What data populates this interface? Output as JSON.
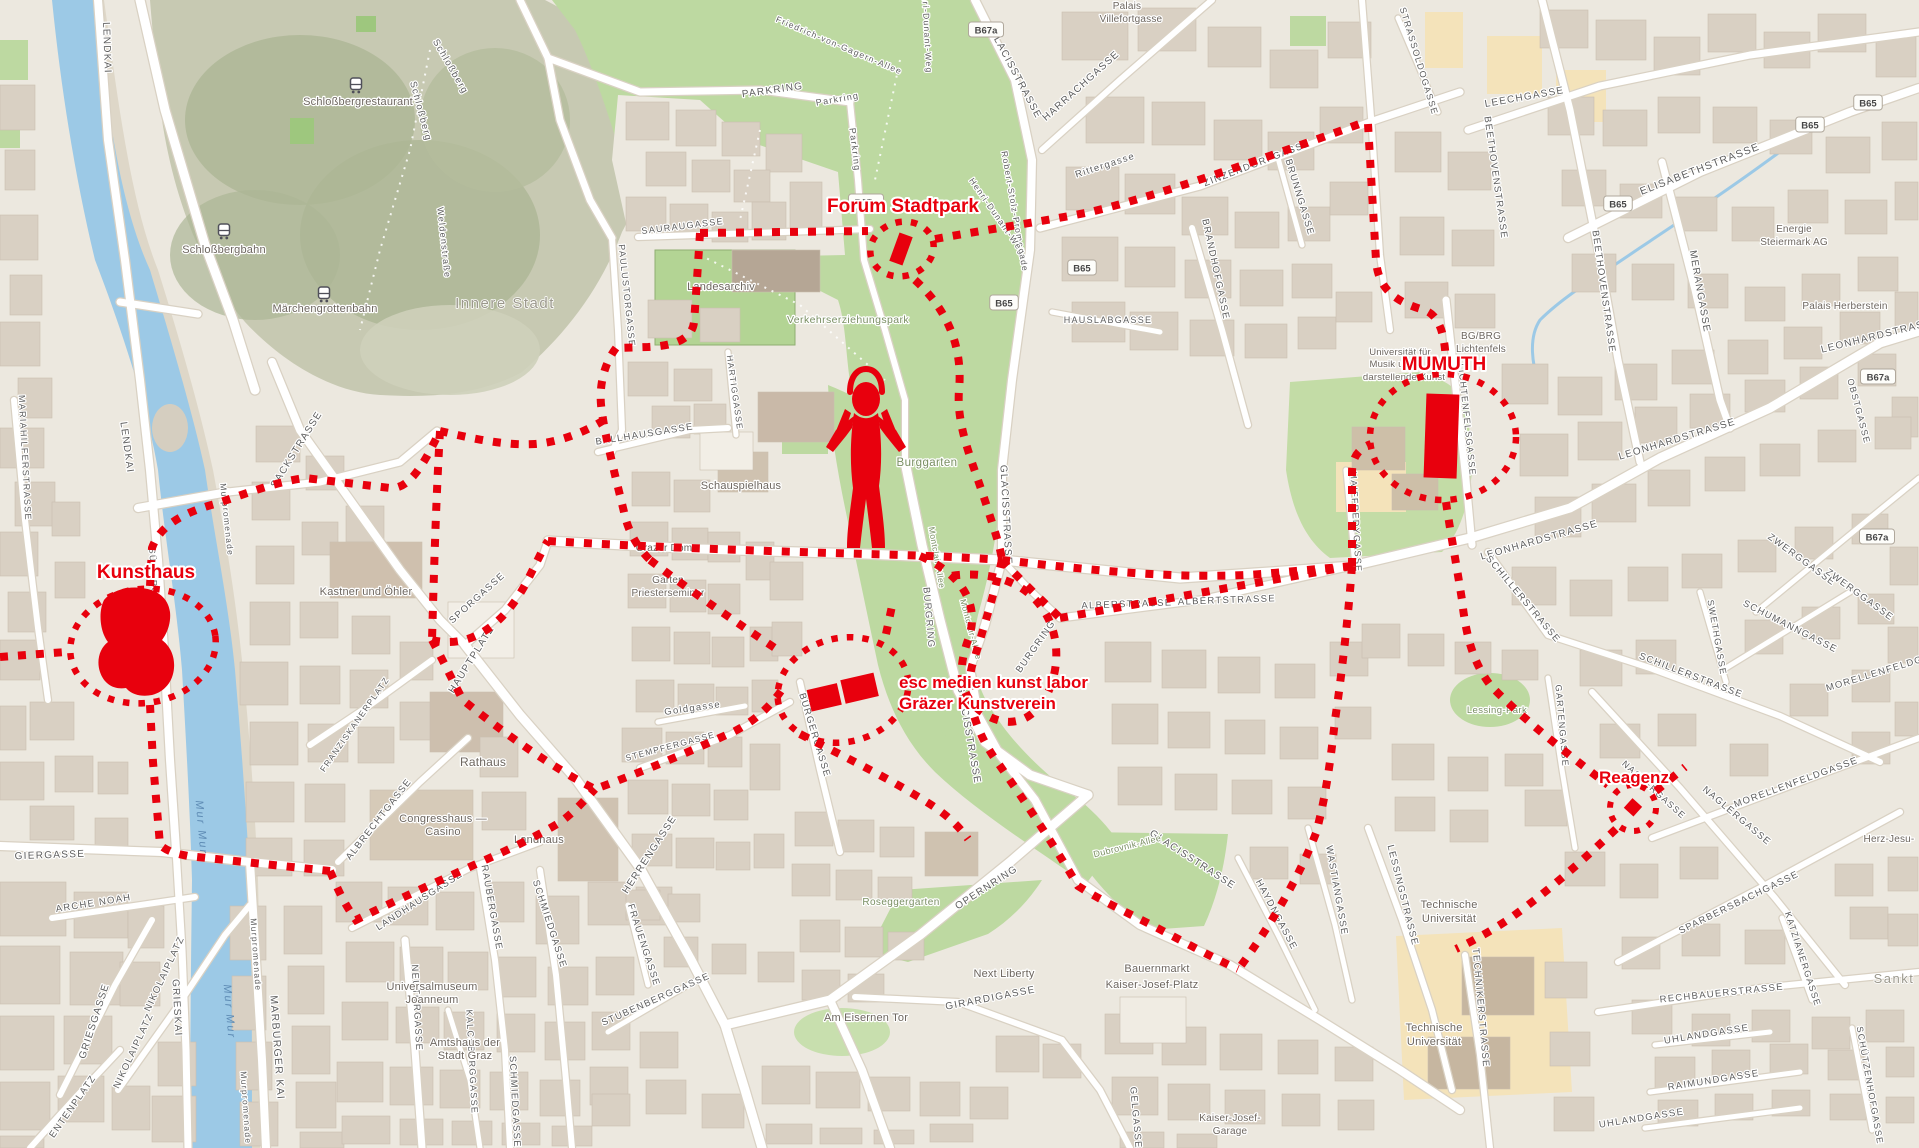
{
  "venues": {
    "kunsthaus": {
      "label": "Kunsthaus"
    },
    "forum_stadtpark": {
      "label": "Forum Stadtpark"
    },
    "mumuth": {
      "label": "MUMUTH"
    },
    "esc": {
      "label_line1": "esc medien kunst labor",
      "label_line2": "Gräzer Kunstverein"
    },
    "reagenz": {
      "label": "Reagenz"
    }
  },
  "map_labels": [
    {
      "t": "LENDKAI",
      "x": 104,
      "y": 48,
      "r": 88
    },
    {
      "t": "LENDKAI",
      "x": 124,
      "y": 448,
      "r": 82
    },
    {
      "t": "MARIAHILFERSTRASSE",
      "x": 22,
      "y": 458,
      "r": 87,
      "s": 9
    },
    {
      "t": "SÜDTIROLER PLATZ",
      "x": 152,
      "y": 600,
      "r": 87,
      "s": 8.5
    },
    {
      "t": "SACKSTRASSE",
      "x": 299,
      "y": 451,
      "r": -58
    },
    {
      "t": "HAUPTPLATZ",
      "x": 474,
      "y": 661,
      "r": -58
    },
    {
      "t": "SPORGASSE",
      "x": 479,
      "y": 600,
      "r": -42,
      "s": 9.5
    },
    {
      "t": "FRANZISKANERPLATZ",
      "x": 357,
      "y": 726,
      "r": -55,
      "s": 8.5
    },
    {
      "t": "ALBRECHTGASSE",
      "x": 381,
      "y": 821,
      "r": -52,
      "s": 9.5
    },
    {
      "t": "LANDHAUSGASSE",
      "x": 421,
      "y": 903,
      "r": -33,
      "s": 9.5
    },
    {
      "t": "RAUBERGASSE",
      "x": 489,
      "y": 908,
      "r": 80,
      "s": 9.5
    },
    {
      "t": "SCHMIEDGASSE",
      "x": 547,
      "y": 925,
      "r": 72,
      "s": 9.5
    },
    {
      "t": "HERRENGASSE",
      "x": 652,
      "y": 856,
      "r": -57
    },
    {
      "t": "FRAUENGASSE",
      "x": 641,
      "y": 946,
      "r": 72,
      "s": 9.5
    },
    {
      "t": "STUBENBERGGASSE",
      "x": 657,
      "y": 1002,
      "r": -24,
      "s": 9.5
    },
    {
      "t": "STEMPFERGASSE",
      "x": 671,
      "y": 749,
      "r": -15,
      "s": 8.5
    },
    {
      "t": "Goldgasse",
      "x": 693,
      "y": 711,
      "r": -8,
      "s": 9.5
    },
    {
      "t": "NEUTORGASSE",
      "x": 414,
      "y": 1008,
      "r": 87,
      "s": 9.5
    },
    {
      "t": "KALCHBERGGASSE",
      "x": 469,
      "y": 1062,
      "r": 87,
      "s": 9
    },
    {
      "t": "SCHMIEDGASSE",
      "x": 512,
      "y": 1102,
      "r": 87,
      "s": 9.5
    },
    {
      "t": "BÜRGERGASSE",
      "x": 812,
      "y": 736,
      "r": 73,
      "s": 9.5
    },
    {
      "t": "BURGRING",
      "x": 926,
      "y": 618,
      "r": 85,
      "s": 9.5
    },
    {
      "t": "BURGRING",
      "x": 1038,
      "y": 648,
      "r": -55,
      "s": 9.5
    },
    {
      "t": "OPERNRING",
      "x": 988,
      "y": 890,
      "r": -33
    },
    {
      "t": "GIRARDIGASSE",
      "x": 991,
      "y": 1001,
      "r": -11
    },
    {
      "t": "GELGASSE",
      "x": 1133,
      "y": 1118,
      "r": 85,
      "s": 9.5
    },
    {
      "t": "GLACISSTRASSE",
      "x": 1013,
      "y": 75,
      "r": 62
    },
    {
      "t": "GLACISSTRASSE",
      "x": 1003,
      "y": 515,
      "r": 87
    },
    {
      "t": "GLACISSTRASSE",
      "x": 966,
      "y": 735,
      "r": 80
    },
    {
      "t": "GLACISSTRASSE",
      "x": 1191,
      "y": 862,
      "r": 33
    },
    {
      "t": "HARRACHGASSE",
      "x": 1083,
      "y": 88,
      "r": -42
    },
    {
      "t": "Rittergasse",
      "x": 1106,
      "y": 168,
      "r": -18,
      "s": 9.5
    },
    {
      "t": "Robert-Stolz-Promenade",
      "x": 1012,
      "y": 212,
      "r": 80,
      "s": 8.5
    },
    {
      "t": "Henri-Dunant-Weg",
      "x": 924,
      "y": 28,
      "r": 87,
      "s": 8.5
    },
    {
      "t": "Henri-Dunant-Weg",
      "x": 995,
      "y": 218,
      "r": 55,
      "s": 8.5
    },
    {
      "t": "Friedrich-von-Gagern-Allee",
      "x": 838,
      "y": 48,
      "r": 23,
      "s": 8.5
    },
    {
      "t": "PARKRING",
      "x": 773,
      "y": 93,
      "r": -8
    },
    {
      "t": "Parkring",
      "x": 838,
      "y": 102,
      "r": -10,
      "s": 9
    },
    {
      "t": "Parkring",
      "x": 852,
      "y": 150,
      "r": 83,
      "s": 9
    },
    {
      "t": "SAURAUGASSE",
      "x": 683,
      "y": 229,
      "r": -7,
      "s": 9
    },
    {
      "t": "PAULUSTORGASSE",
      "x": 624,
      "y": 296,
      "r": 84,
      "s": 9
    },
    {
      "t": "HARTIGGASSE",
      "x": 732,
      "y": 393,
      "r": 82,
      "s": 8.5
    },
    {
      "t": "BALLHAUSGASSE",
      "x": 645,
      "y": 437,
      "r": -9,
      "s": 9.5
    },
    {
      "t": "MAIFFREDYGASSE",
      "x": 1353,
      "y": 522,
      "r": 87,
      "s": 9
    },
    {
      "t": "ALBERSTRASSE",
      "x": 1127,
      "y": 607,
      "r": -2,
      "s": 9.5
    },
    {
      "t": "ALBERTSTRASSE",
      "x": 1227,
      "y": 603,
      "r": -2,
      "s": 9.5
    },
    {
      "t": "HAUSLABGASSE",
      "x": 1108,
      "y": 323,
      "r": 0,
      "s": 9
    },
    {
      "t": "BRANDHOFGASSE",
      "x": 1213,
      "y": 270,
      "r": 78,
      "s": 9.5
    },
    {
      "t": "ZINZENDORFGASSE",
      "x": 1258,
      "y": 166,
      "r": -21,
      "s": 9.5
    },
    {
      "t": "BRUNNGASSE",
      "x": 1297,
      "y": 198,
      "r": 73,
      "s": 9.5
    },
    {
      "t": "LEECHGASSE",
      "x": 1525,
      "y": 100,
      "r": -10
    },
    {
      "t": "BEETHOVENSTRASSE",
      "x": 1493,
      "y": 178,
      "r": 82,
      "s": 9.5
    },
    {
      "t": "BEETHOVENSTRASSE",
      "x": 1601,
      "y": 292,
      "r": 82,
      "s": 9.5
    },
    {
      "t": "STRASSOLDOGASSE",
      "x": 1416,
      "y": 62,
      "r": 73,
      "s": 9
    },
    {
      "t": "ELISABETHSTRASSE",
      "x": 1701,
      "y": 172,
      "r": -21,
      "s": 10.5
    },
    {
      "t": "MERANGASSE",
      "x": 1697,
      "y": 292,
      "r": 80,
      "s": 10
    },
    {
      "t": "LEONHARDSTRASSE",
      "x": 1678,
      "y": 442,
      "r": -17
    },
    {
      "t": "LEONHARDSTRASSE",
      "x": 1540,
      "y": 543,
      "r": -16
    },
    {
      "t": "LEONHARDSTRASSE",
      "x": 1881,
      "y": 338,
      "r": -14
    },
    {
      "t": "LICHTENFELSGASSE",
      "x": 1464,
      "y": 420,
      "r": 84,
      "s": 9
    },
    {
      "t": "SCHILLERSTRASSE",
      "x": 1521,
      "y": 601,
      "r": 50,
      "s": 9.5
    },
    {
      "t": "SCHILLERSTRASSE",
      "x": 1690,
      "y": 678,
      "r": 21,
      "s": 9.5
    },
    {
      "t": "SWETHGASSE",
      "x": 1714,
      "y": 638,
      "r": 80,
      "s": 9
    },
    {
      "t": "SCHUMANNGASSE",
      "x": 1789,
      "y": 629,
      "r": 27,
      "s": 9.5
    },
    {
      "t": "ZWERGGASSE",
      "x": 1800,
      "y": 562,
      "r": 36,
      "s": 9.5
    },
    {
      "t": "ZWERGGASSE",
      "x": 1858,
      "y": 597,
      "r": 36,
      "s": 9.5
    },
    {
      "t": "OBSTGASSE",
      "x": 1856,
      "y": 412,
      "r": 75,
      "s": 9
    },
    {
      "t": "MORELLENFELDGASSE",
      "x": 1797,
      "y": 785,
      "r": -20,
      "s": 9.5
    },
    {
      "t": "MORELLENFELDGASSE",
      "x": 1890,
      "y": 672,
      "r": -17,
      "s": 9.5
    },
    {
      "t": "NAGLERGASSE",
      "x": 1652,
      "y": 792,
      "r": 42,
      "s": 9
    },
    {
      "t": "NAGLERGASSE",
      "x": 1735,
      "y": 818,
      "r": 40,
      "s": 9.5
    },
    {
      "t": "GARTENGASSE",
      "x": 1559,
      "y": 726,
      "r": 85,
      "s": 9
    },
    {
      "t": "LESSINGSTRASSE",
      "x": 1400,
      "y": 896,
      "r": 76,
      "s": 9.5
    },
    {
      "t": "WASTIANGASSE",
      "x": 1334,
      "y": 891,
      "r": 80,
      "s": 9.5
    },
    {
      "t": "HAYDNGASSE",
      "x": 1274,
      "y": 916,
      "r": 62,
      "s": 9.5
    },
    {
      "t": "TECHNIKERSTRASSE",
      "x": 1478,
      "y": 1008,
      "r": 85,
      "s": 9.5
    },
    {
      "t": "RECHBAUERSTRASSE",
      "x": 1722,
      "y": 996,
      "r": -6,
      "s": 9.5
    },
    {
      "t": "SPARBERSBACHGASSE",
      "x": 1740,
      "y": 905,
      "r": -26,
      "s": 9.5
    },
    {
      "t": "KATZIANERGASSE",
      "x": 1800,
      "y": 960,
      "r": 72,
      "s": 9
    },
    {
      "t": "RAIMUNDGASSE",
      "x": 1714,
      "y": 1083,
      "r": -9,
      "s": 9.5
    },
    {
      "t": "UHLANDGASSE",
      "x": 1707,
      "y": 1037,
      "r": -9,
      "s": 9.5
    },
    {
      "t": "UHLANDGASSE",
      "x": 1642,
      "y": 1121,
      "r": -9,
      "s": 9.5
    },
    {
      "t": "SCHÜTZENHOFGASSE",
      "x": 1867,
      "y": 1086,
      "r": 80,
      "s": 9
    },
    {
      "t": "GIERGASSE",
      "x": 50,
      "y": 858,
      "r": -2
    },
    {
      "t": "ARCHE NOAH",
      "x": 94,
      "y": 906,
      "r": -9,
      "s": 9.5
    },
    {
      "t": "GRIESGASSE",
      "x": 97,
      "y": 1022,
      "r": -72
    },
    {
      "t": "NIKOLAIPLATZ",
      "x": 167,
      "y": 975,
      "r": -65,
      "s": 9.5
    },
    {
      "t": "NIKOLAIPLATZ",
      "x": 136,
      "y": 1052,
      "r": -65,
      "s": 9.5
    },
    {
      "t": "GRIESKAI",
      "x": 174,
      "y": 1008,
      "r": 87
    },
    {
      "t": "ENTENPLATZ",
      "x": 75,
      "y": 1108,
      "r": -55,
      "s": 9.5
    },
    {
      "t": "MARBURGER KAI",
      "x": 274,
      "y": 1048,
      "r": 86,
      "s": 10.5
    },
    {
      "t": "Murpromenade",
      "x": 253,
      "y": 955,
      "r": 86,
      "s": 8.5
    },
    {
      "t": "Murpromenade",
      "x": 243,
      "y": 1108,
      "r": 86,
      "s": 8.5
    },
    {
      "t": "Murpromenade",
      "x": 224,
      "y": 520,
      "r": 84,
      "s": 8.5
    },
    {
      "t": "Weldenstraße",
      "x": 441,
      "y": 243,
      "r": 84,
      "s": 9
    },
    {
      "t": "Schloßberg",
      "x": 418,
      "y": 112,
      "r": 75,
      "s": 9.5
    },
    {
      "t": "Schloßberg",
      "x": 448,
      "y": 68,
      "r": 60,
      "s": 9.5
    },
    {
      "t": "Schloßbergrestaurant",
      "x": 358,
      "y": 105,
      "c": "poi"
    },
    {
      "t": "Schloßbergbahn",
      "x": 224,
      "y": 253,
      "c": "poi"
    },
    {
      "t": "Märchengrottenbahn",
      "x": 325,
      "y": 312,
      "c": "poi"
    },
    {
      "t": "Landesarchiv",
      "x": 721,
      "y": 290,
      "c": "poi"
    },
    {
      "t": "Schauspielhaus",
      "x": 741,
      "y": 489,
      "c": "poi"
    },
    {
      "t": "Kastner und Öhler",
      "x": 366,
      "y": 595,
      "c": "poi"
    },
    {
      "t": "Rathaus",
      "x": 483,
      "y": 766,
      "c": "poi",
      "s": 12
    },
    {
      "t": "Congresshaus —",
      "x": 443,
      "y": 822,
      "c": "poi"
    },
    {
      "t": "Casino",
      "x": 443,
      "y": 835,
      "c": "poi"
    },
    {
      "t": "Landhaus",
      "x": 539,
      "y": 843,
      "c": "poi"
    },
    {
      "t": "Universalmuseum",
      "x": 432,
      "y": 990,
      "c": "poi"
    },
    {
      "t": "Joanneum",
      "x": 432,
      "y": 1003,
      "c": "poi"
    },
    {
      "t": "Amtshaus der",
      "x": 465,
      "y": 1046,
      "c": "poi"
    },
    {
      "t": "Stadt Graz",
      "x": 465,
      "y": 1059,
      "c": "poi"
    },
    {
      "t": "Next Liberty",
      "x": 1004,
      "y": 977,
      "c": "poi"
    },
    {
      "t": "Bauernmarkt",
      "x": 1157,
      "y": 972,
      "c": "poi"
    },
    {
      "t": "Kaiser-Josef-Platz",
      "x": 1152,
      "y": 988,
      "c": "poi"
    },
    {
      "t": "Am Eisernen Tor",
      "x": 866,
      "y": 1021,
      "c": "poi"
    },
    {
      "t": "Grazer Dom",
      "x": 664,
      "y": 551,
      "c": "poi",
      "s": 10
    },
    {
      "t": "Garten",
      "x": 668,
      "y": 583,
      "c": "poi",
      "s": 10
    },
    {
      "t": "Priesterseminar",
      "x": 668,
      "y": 596,
      "c": "poi",
      "s": 10
    },
    {
      "t": "Kaiser-Josef-",
      "x": 1230,
      "y": 1121,
      "c": "poi",
      "s": 10
    },
    {
      "t": "Garage",
      "x": 1230,
      "y": 1134,
      "c": "poi",
      "s": 10
    },
    {
      "t": "Technische",
      "x": 1449,
      "y": 908,
      "c": "poi"
    },
    {
      "t": "Universität",
      "x": 1449,
      "y": 922,
      "c": "poi"
    },
    {
      "t": "Technische",
      "x": 1434,
      "y": 1031,
      "c": "poi"
    },
    {
      "t": "Universität",
      "x": 1434,
      "y": 1045,
      "c": "poi"
    },
    {
      "t": "Universität für",
      "x": 1400,
      "y": 355,
      "c": "poi",
      "s": 9.5
    },
    {
      "t": "Musik und",
      "x": 1392,
      "y": 367,
      "c": "poi",
      "s": 9.5
    },
    {
      "t": "darstellende Kunst",
      "x": 1404,
      "y": 380,
      "c": "poi",
      "s": 9.5
    },
    {
      "t": "BG/BRG",
      "x": 1481,
      "y": 339,
      "c": "poi",
      "s": 10
    },
    {
      "t": "Lichtenfels",
      "x": 1481,
      "y": 352,
      "c": "poi",
      "s": 10
    },
    {
      "t": "Energie",
      "x": 1794,
      "y": 232,
      "c": "poi",
      "s": 10
    },
    {
      "t": "Steiermark AG",
      "x": 1794,
      "y": 245,
      "c": "poi",
      "s": 10
    },
    {
      "t": "Palais Herberstein",
      "x": 1845,
      "y": 309,
      "c": "poi",
      "s": 10
    },
    {
      "t": "Palais",
      "x": 1127,
      "y": 9,
      "c": "poi",
      "s": 10
    },
    {
      "t": "Villefortgasse",
      "x": 1131,
      "y": 22,
      "c": "poi",
      "s": 10
    },
    {
      "t": "Herz-Jesu-",
      "x": 1889,
      "y": 842,
      "c": "poi",
      "s": 10
    },
    {
      "t": "Verkehrserziehungspark",
      "x": 848,
      "y": 323,
      "c": "park"
    },
    {
      "t": "Burggarten",
      "x": 927,
      "y": 466,
      "c": "park",
      "s": 11.5
    },
    {
      "t": "Roseggergarten",
      "x": 901,
      "y": 905,
      "c": "park",
      "s": 10
    },
    {
      "t": "Lessing-Park",
      "x": 1497,
      "y": 713,
      "c": "park",
      "s": 9.5
    },
    {
      "t": "Dubrovnik-Allee",
      "x": 1128,
      "y": 849,
      "r": -14,
      "c": "park",
      "s": 9
    },
    {
      "t": "Montclair-Allee",
      "x": 934,
      "y": 558,
      "r": 80,
      "c": "park",
      "s": 8.5
    },
    {
      "t": "Montclair-Allee",
      "x": 968,
      "y": 630,
      "r": 75,
      "c": "park",
      "s": 8.5
    },
    {
      "t": "Innere Stadt",
      "x": 505,
      "y": 308,
      "c": "area"
    },
    {
      "t": "Sankt",
      "x": 1894,
      "y": 983,
      "c": "area",
      "s": 13
    },
    {
      "t": "Mur Mur",
      "x": 226,
      "y": 1012,
      "r": 85,
      "c": "water"
    },
    {
      "t": "Mur Mur",
      "x": 198,
      "y": 828,
      "r": 85,
      "c": "water"
    }
  ],
  "badges": [
    {
      "t": "B67a",
      "x": 986,
      "y": 30
    },
    {
      "t": "B67a",
      "x": 866,
      "y": 202
    },
    {
      "t": "B65",
      "x": 1082,
      "y": 268
    },
    {
      "t": "B65",
      "x": 1004,
      "y": 303
    },
    {
      "t": "B65",
      "x": 1868,
      "y": 103
    },
    {
      "t": "B65",
      "x": 1810,
      "y": 125
    },
    {
      "t": "B65",
      "x": 1618,
      "y": 204
    },
    {
      "t": "B67a",
      "x": 1878,
      "y": 377
    },
    {
      "t": "B67a",
      "x": 1877,
      "y": 537
    }
  ],
  "station_icons": [
    {
      "name": "railway-station-icon",
      "x": 356,
      "y": 86
    },
    {
      "name": "railway-station-icon",
      "x": 224,
      "y": 232
    },
    {
      "name": "railway-station-icon",
      "x": 324,
      "y": 295
    }
  ],
  "colors": {
    "route_red": "#e8000d",
    "water_blue": "#9cc9e6",
    "park_green": "#bdd9a1",
    "hill_green": "#c7c9b2",
    "background": "#ece8df",
    "building": "#d9d0c3",
    "road": "#ffffff",
    "university_yellow": "#f4e3ba"
  }
}
